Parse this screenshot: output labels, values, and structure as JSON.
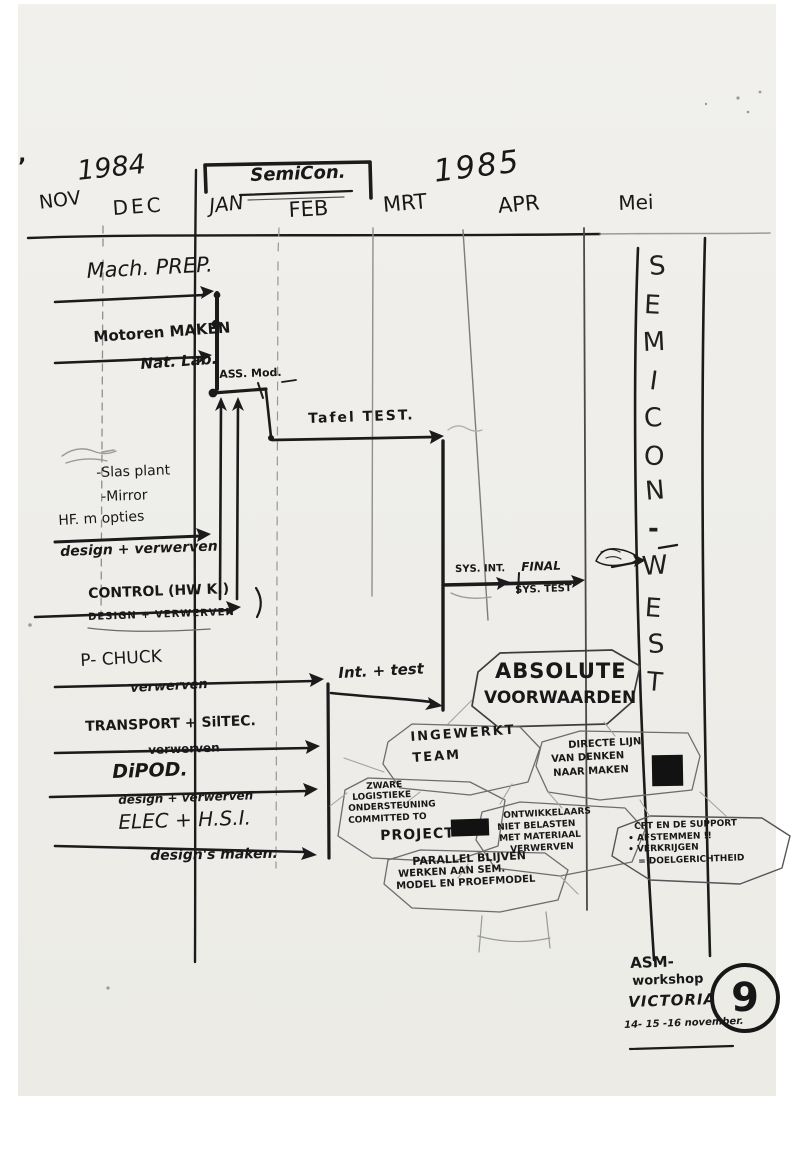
{
  "marks": {
    "stray": "’"
  },
  "timeline": {
    "year_left": "1984",
    "banner": "SemiCon.",
    "year_right": "1985",
    "months": [
      "NOV",
      "DEC",
      "JAN",
      "FEB",
      "MRT",
      "APR",
      "Mei"
    ]
  },
  "tasks": {
    "mach_prep": {
      "label": "Mach. PREP."
    },
    "motoren": {
      "label": "Motoren MAKEN",
      "sub": "Nat. Lab."
    },
    "ass_mod": {
      "label": "ASS. Mod."
    },
    "tafel_test": {
      "label": "Tafel TEST."
    },
    "opties": {
      "line1": "-Slas plant",
      "line2": "-Mirror",
      "line3": "HF. m opties",
      "sub": "design + verwerven"
    },
    "control": {
      "label": "CONTROL (HW K.)",
      "sub": "DESIGN + VERWERVEN"
    },
    "p_chuck": {
      "label": "P- CHUCK",
      "sub": "verwerven"
    },
    "transport": {
      "label": "TRANSPORT + SilTEC.",
      "sub": "verwerven"
    },
    "dipod": {
      "label": "DiPOD.",
      "sub": "design + verwerven"
    },
    "elec": {
      "label": "ELEC + H.S.I.",
      "sub": "design's maken."
    },
    "sys_int": {
      "label": "SYS. INT."
    },
    "final": {
      "line1": "FINAL",
      "line2": "SYS. TEST"
    },
    "int_test": {
      "label": "Int. + test"
    }
  },
  "notes": {
    "absolute": {
      "line1": "ABSOLUTE",
      "line2": "VOORWAARDEN"
    },
    "ingewerkt": {
      "line1": "INGEWERKT",
      "line2": "TEAM"
    },
    "directe": {
      "line1": "DIRECTE LIJN",
      "line2": "VAN DENKEN",
      "line3": "NAAR MAKEN"
    },
    "zware": {
      "line1": "ZWARE",
      "line2": "LOGISTIEKE",
      "line3": "ONDERSTEUNING",
      "line4": "COMMITTED TO",
      "line5": "PROJECT"
    },
    "ontwikkelaars": {
      "line1": "ONTWIKKELAARS",
      "line2": "NIET BELASTEN",
      "line3": "MET MATERIAAL",
      "line4": "VERWERVEN"
    },
    "cft": {
      "line1": "CFT EN DE SUPPORT",
      "line2": "• AFSTEMMEN !!",
      "line3": "• VERKRIJGEN",
      "line4": "= DOELGERICHTHEID"
    },
    "parallel": {
      "line1": "PARALLEL BLIJVEN",
      "line2": "WERKEN AAN SEM.",
      "line3": "MODEL EN PROEFMODEL"
    }
  },
  "side_banner": {
    "letters": [
      "S",
      "E",
      "M",
      "I",
      "C",
      "O",
      "N",
      "-",
      "W",
      "E",
      "S",
      "T"
    ]
  },
  "footer": {
    "line1": "ASM-",
    "line2": "workshop",
    "line3": "VICTORIA",
    "line4": "14- 15 -16 november.",
    "badge": "9"
  },
  "colors": {
    "ink": "#1b1b1b",
    "faint": "#9a9a9a",
    "paper": "#efeeea"
  }
}
